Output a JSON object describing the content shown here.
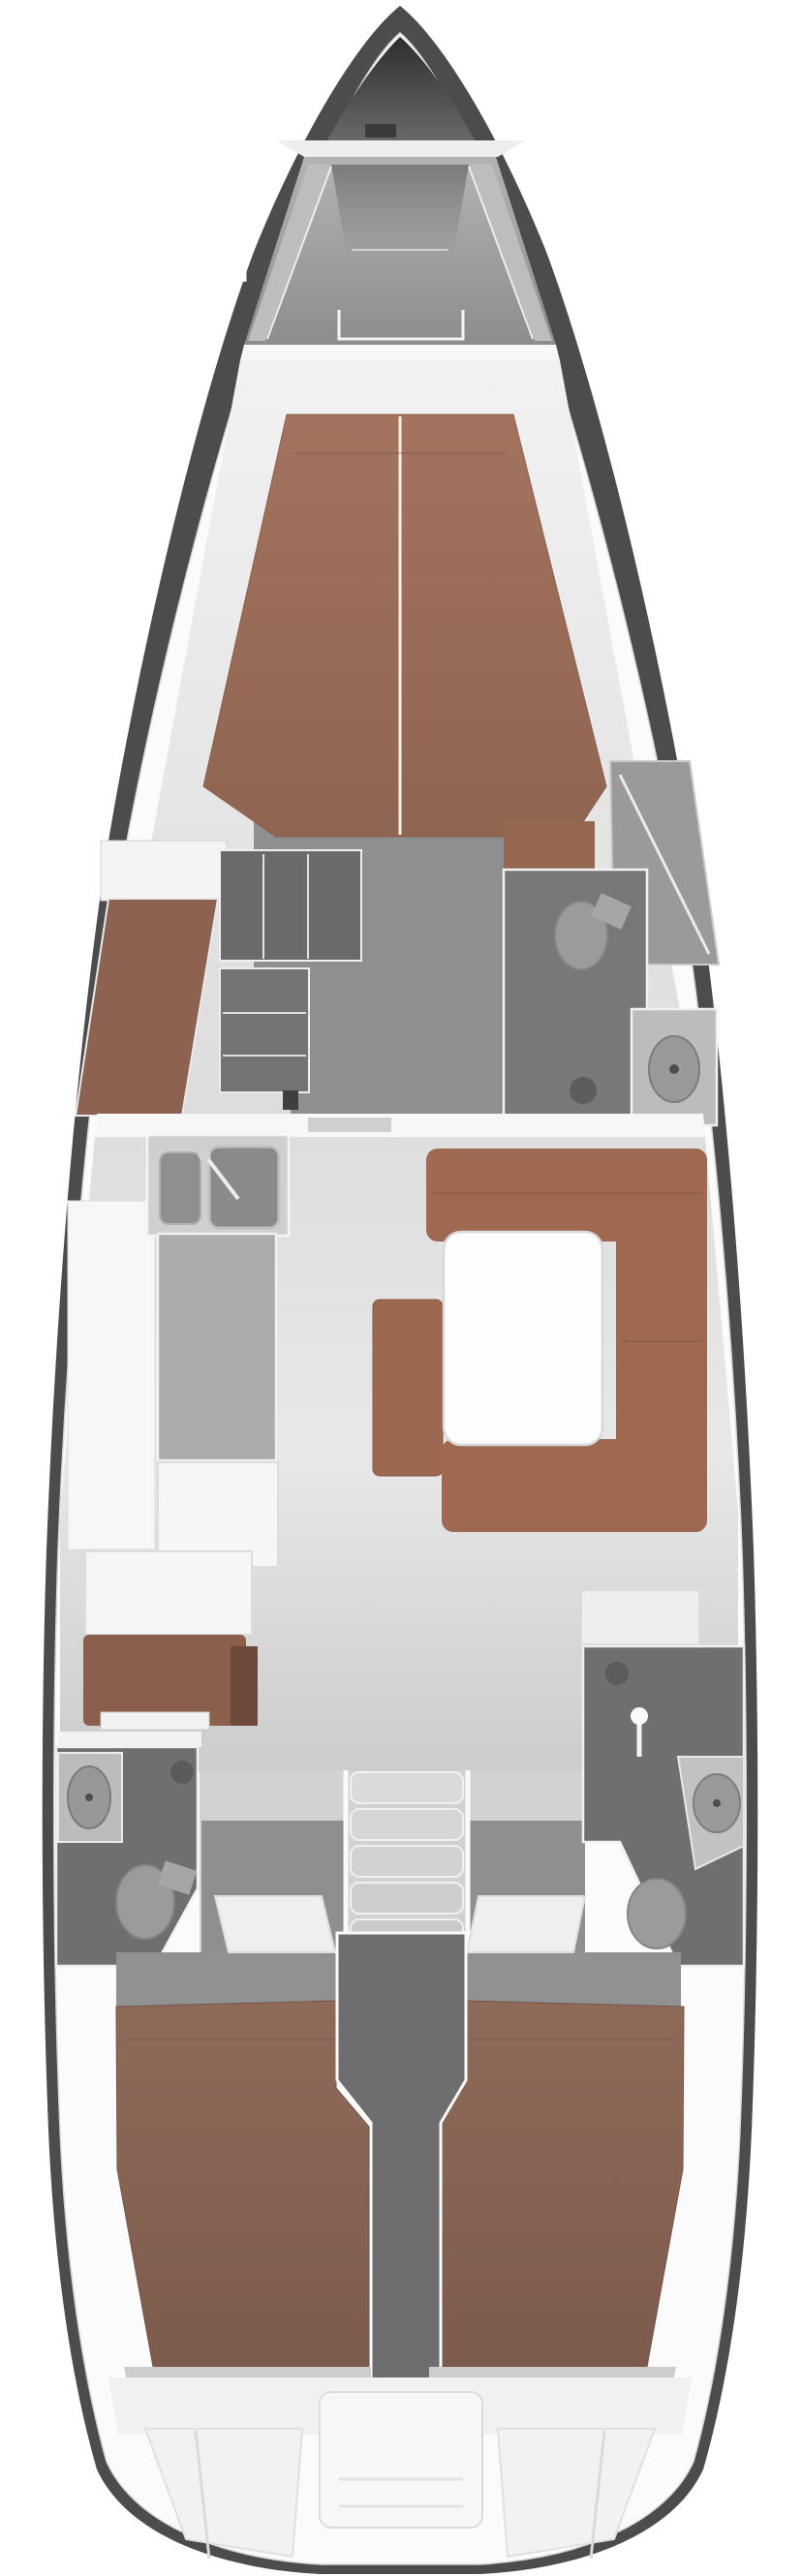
{
  "document": {
    "kind": "sailing-yacht-interior-floor-plan",
    "view": "top-down, bow at top, stern at bottom",
    "visible_text": [],
    "background_color": "#ffffff"
  },
  "palette": {
    "hull-dark": "#4c4c4c",
    "deck-white": "#fbfbfb",
    "bow1": "#2e2e2e",
    "bow2": "#666666",
    "foredeck1": "#aaaaaa",
    "foredeck2": "#8d8d8d",
    "bulkhead": "#f7f7f7",
    "floor1": "#e6e6e6",
    "floor2": "#c9c9c9",
    "floor-mid": "#8f8f8f",
    "berth1": "#a3735e",
    "berth2": "#8f6551",
    "settee": "#9e6950",
    "bench": "#9c6850",
    "aftberth1": "#8f6a59",
    "aftberth2": "#7d5b4c",
    "wood-dark": "#6e4a3c",
    "wood-desk": "#8a5f4c",
    "wood-locker": "#8d6250",
    "wall-dark": "#6f6f6f",
    "fixture": "#9b9b9b",
    "vanity": "#bcbcbc",
    "counter": "#ababab",
    "white-furn": "#f6f6f6",
    "steps": "#d6d6d6",
    "column": "#6e6e6e",
    "shelf": "#cdcdcd",
    "seam": "#f2f2f2"
  },
  "layout_inventory": {
    "bow": [
      "anchor-locker",
      "locker-lid",
      "windlass"
    ],
    "foredeck": [
      "deck-surface",
      "toe-rails",
      "deck-hatch"
    ],
    "forward-cabin": [
      "v-berth-double",
      "berth-center-seam",
      "foot-floor",
      "port-shelf-seat",
      "port-hanging-locker",
      "center-wardrobe",
      "lower-cabinet",
      "door-handle",
      "starboard-vanity-seat",
      "starboard-locker"
    ],
    "forward-head": [
      "shower-room",
      "toilet",
      "floor-drain",
      "sink-vanity",
      "wash-basin"
    ],
    "salon": [
      "galley-sink-unit",
      "small-basin",
      "large-basin",
      "faucet",
      "galley-worktop",
      "galley-counter-white",
      "galley-lower-counter",
      "port-side-locker",
      "nav-desk",
      "instrument-strip",
      "center-bench",
      "u-settee",
      "salon-table"
    ],
    "companionway": [
      "step-1",
      "step-2",
      "step-3",
      "step-4",
      "step-5",
      "side-rails"
    ],
    "aft-head-port": [
      "vanity-counter",
      "wash-basin",
      "toilet",
      "floor-drain"
    ],
    "aft-head-starboard": [
      "locker-top",
      "floor-drain",
      "shower-wand",
      "wash-basin",
      "toilet"
    ],
    "aft-cabin-port": [
      "entry-floor",
      "cabin-door",
      "double-berth"
    ],
    "aft-cabin-starboard": [
      "entry-floor",
      "cabin-door",
      "double-berth"
    ],
    "engine-compartment": [
      "center-column"
    ],
    "stern": [
      "port-shelf",
      "starboard-shelf",
      "transom-band",
      "center-lazarette",
      "port-wing-panel",
      "starboard-wing-panel"
    ]
  },
  "counts": {
    "cabins": 3,
    "heads": 3,
    "salon-tables": 1,
    "companionway-steps": 5
  }
}
